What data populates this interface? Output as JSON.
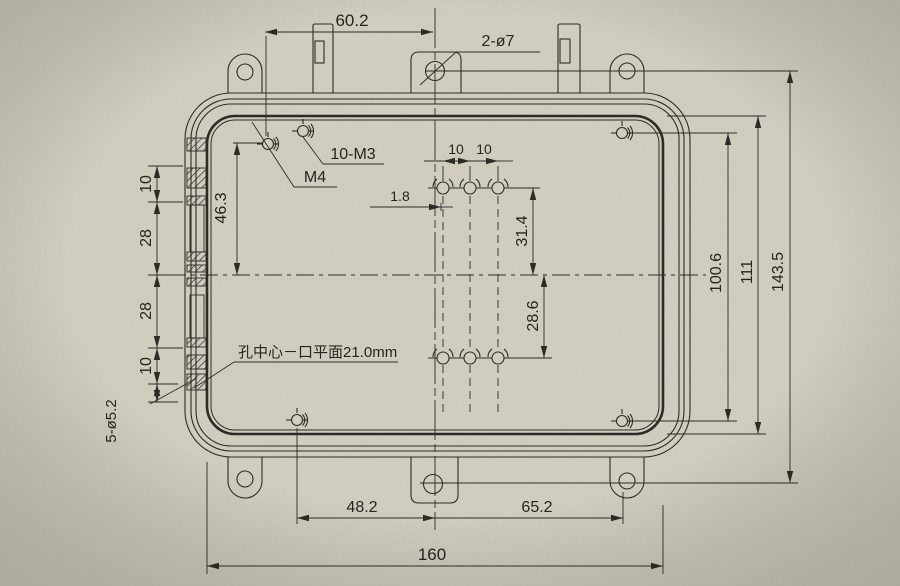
{
  "colors": {
    "paper": "#d1cdbf",
    "ink": "#2d2b26"
  },
  "dims": {
    "top_width": "60.2",
    "top_holes": "2-ø7",
    "thread_ten_m3": "10-M3",
    "thread_m4": "M4",
    "left_46_3": "46.3",
    "pitch_left": "10",
    "pitch_right": "10",
    "offset_1_8": "1.8",
    "span_31_4": "31.4",
    "span_28_6": "28.6",
    "chain_10_top": "10",
    "chain_28_top": "28",
    "chain_28_bottom": "28",
    "chain_10_bottom": "10",
    "holes_5_2": "5-ø5.2",
    "right_100_6": "100.6",
    "right_111": "111",
    "right_143_5": "143.5",
    "bottom_48_2": "48.2",
    "bottom_65_2": "65.2",
    "bottom_160": "160"
  },
  "notes": {
    "hole_plane": "孔中心－口平面21.0mm"
  }
}
